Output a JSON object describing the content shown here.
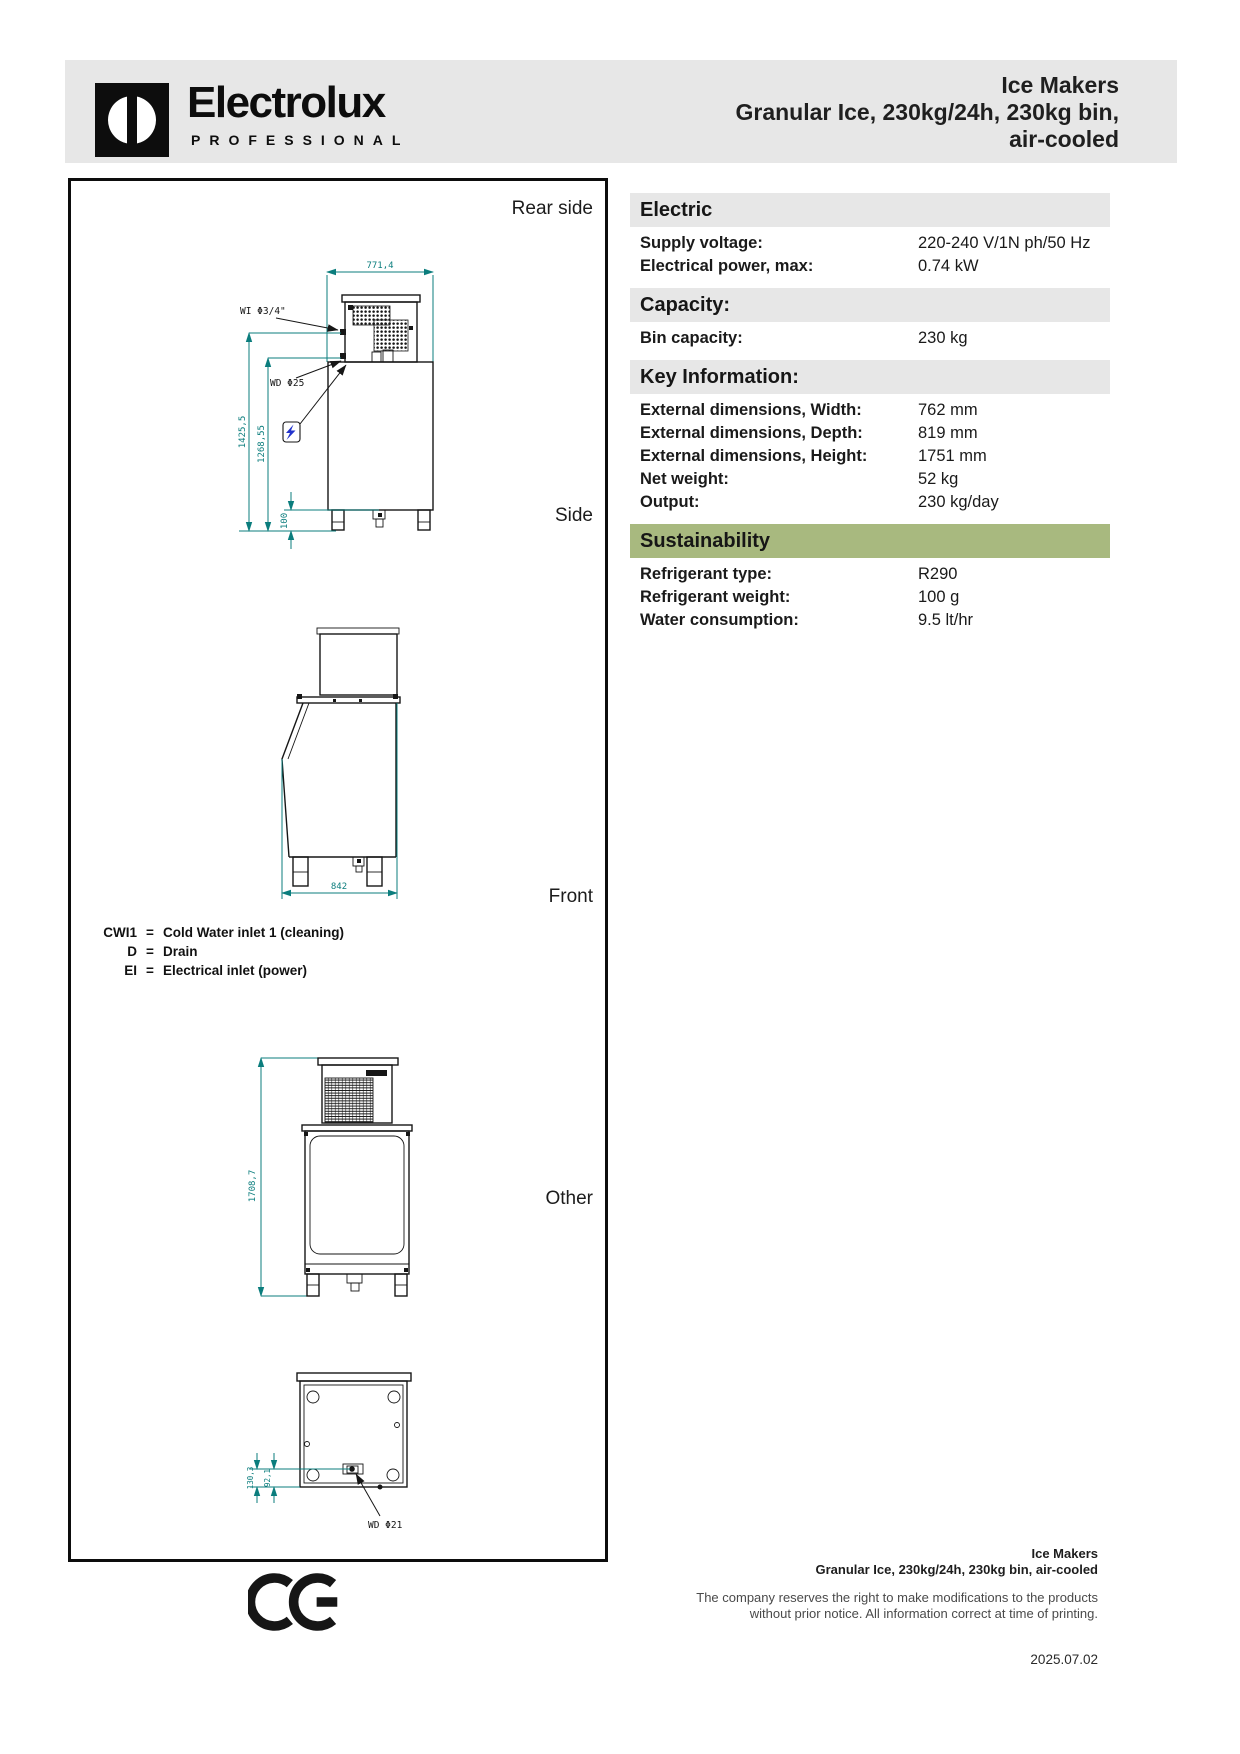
{
  "header": {
    "brand": "Electrolux",
    "brand_sub": "PROFESSIONAL",
    "product_line1": "Ice Makers",
    "product_line2": "Granular Ice, 230kg/24h, 230kg bin,",
    "product_line3": "air-cooled"
  },
  "drawings": {
    "view_labels": {
      "rear": "Rear side",
      "side": "Side",
      "front": "Front",
      "other": "Other"
    },
    "dimensions": {
      "rear_top_width": "771,4",
      "rear_height_1": "1425,5",
      "rear_height_2": "1268,55",
      "rear_clearance": "100",
      "rear_water_inlet": "WI Φ3/4\"",
      "rear_water_drain": "WD Φ25",
      "side_depth": "842",
      "front_height": "1708,7",
      "other_offset_1": "130,3",
      "other_offset_2": "92,1",
      "other_water_drain": "WD Φ21"
    },
    "legend": [
      {
        "code": "CWI1",
        "separator": "=",
        "description": "Cold Water inlet 1 (cleaning)"
      },
      {
        "code": "D",
        "separator": "=",
        "description": "Drain"
      },
      {
        "code": "EI",
        "separator": "=",
        "description": "Electrical inlet (power)"
      }
    ]
  },
  "specs": {
    "sections": [
      {
        "title": "Electric",
        "variant": "gray",
        "rows": [
          {
            "label": "Supply voltage:",
            "value": "220-240 V/1N ph/50 Hz"
          },
          {
            "label": "Electrical power, max:",
            "value": "0.74 kW"
          }
        ]
      },
      {
        "title": "Capacity:",
        "variant": "gray",
        "rows": [
          {
            "label": "Bin capacity:",
            "value": "230 kg"
          }
        ]
      },
      {
        "title": "Key Information:",
        "variant": "gray",
        "rows": [
          {
            "label": "External dimensions, Width:",
            "value": "762 mm"
          },
          {
            "label": "External dimensions, Depth:",
            "value": "819 mm"
          },
          {
            "label": "External dimensions, Height:",
            "value": "1751 mm"
          },
          {
            "label": "Net weight:",
            "value": "52 kg"
          },
          {
            "label": "Output:",
            "value": "230 kg/day"
          }
        ]
      },
      {
        "title": "Sustainability",
        "variant": "green",
        "rows": [
          {
            "label": "Refrigerant type:",
            "value": "R290"
          },
          {
            "label": "Refrigerant weight:",
            "value": "100 g"
          },
          {
            "label": "Water consumption:",
            "value": "9.5 lt/hr"
          }
        ]
      }
    ]
  },
  "footer": {
    "product_line1": "Ice Makers",
    "product_line2": "Granular Ice, 230kg/24h, 230kg bin, air-cooled",
    "disclaimer_line1": "The company reserves the right to make modifications to the products",
    "disclaimer_line2": "without prior notice. All information correct at time of printing.",
    "date": "2025.07.02"
  },
  "colors": {
    "band_gray": "#e7e7e7",
    "accent_green": "#a8b97f",
    "dimension_teal": "#0b7d7d",
    "electric_blue": "#2233cc"
  }
}
